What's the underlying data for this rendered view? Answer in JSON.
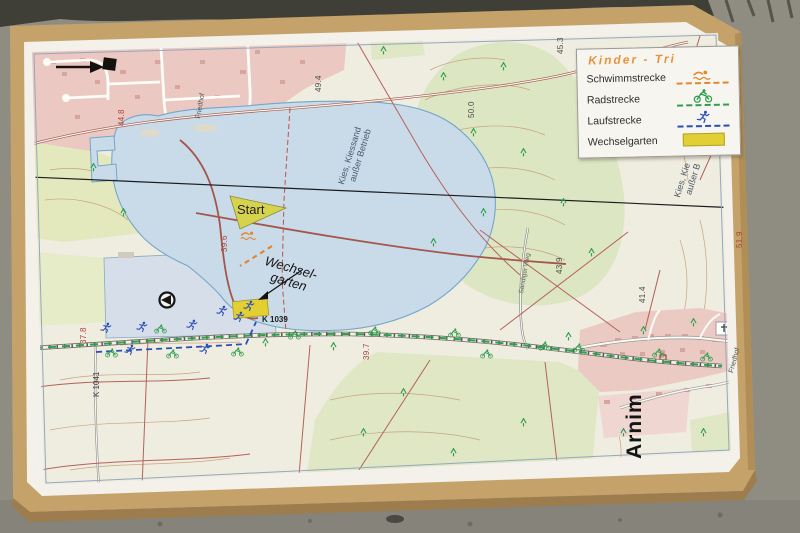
{
  "legend": {
    "title": "Kinder - Tri",
    "items": [
      {
        "label": "Schwimmstrecke",
        "icon": "swimmer-icon",
        "color": "#e0882f"
      },
      {
        "label": "Radstrecke",
        "icon": "cyclist-icon",
        "color": "#2f9e4f"
      },
      {
        "label": "Laufstrecke",
        "icon": "runner-icon",
        "color": "#2a50b8"
      },
      {
        "label": "Wechselgarten",
        "icon": "wechselgarten-swatch",
        "color": "#e2ce35"
      }
    ]
  },
  "map_labels": {
    "start": "Start",
    "wechselgarten_line1": "Wechsel-",
    "wechselgarten_line2": "garten",
    "road_k1039": "K 1039",
    "road_k1041": "K 1041",
    "town": "Arnim",
    "cemetery_1": "Friedhof",
    "cemetery_2": "Friedhof",
    "gravel_pit_line1": "Kies, Kiessand",
    "gravel_pit_line2": "außer Betrieb",
    "gravel_pit_right_line1": "Kies, Kie",
    "gravel_pit_right_line2": "außer B",
    "road_sandiger_weg": "Sandiger Weg"
  },
  "elevations": [
    {
      "value": "44.8"
    },
    {
      "value": "49.4"
    },
    {
      "value": "50.0"
    },
    {
      "value": "45.3"
    },
    {
      "value": "39.6"
    },
    {
      "value": "37.8"
    },
    {
      "value": "39.7"
    },
    {
      "value": "43.9"
    },
    {
      "value": "41.4"
    },
    {
      "value": "51.9"
    }
  ],
  "colors": {
    "swim_route": "#e0882f",
    "bike_route": "#2f9e4f",
    "run_route": "#2a50b8",
    "wechselgarten": "#e2ce35",
    "lake": "#c9dbe9",
    "settlement_pink": "#ebc8c2",
    "field_green": "#dce6c2",
    "board_wood": "#c4a26a",
    "pavement": "#8f8c82"
  }
}
